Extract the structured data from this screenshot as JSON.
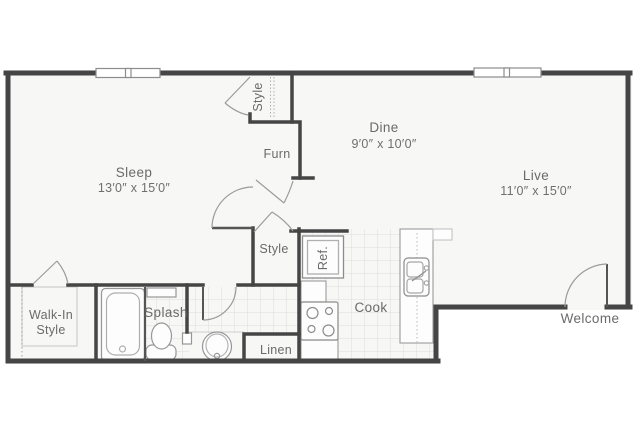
{
  "plan": {
    "type": "apartment-floor-plan",
    "rooms": {
      "sleep": {
        "label": "Sleep",
        "dims": "13′0″ x 15′0″"
      },
      "dine": {
        "label": "Dine",
        "dims": "9′0″ x 10′0″"
      },
      "live": {
        "label": "Live",
        "dims": "11′0″ x 15′0″"
      },
      "furnace": {
        "label": "Furn"
      },
      "closet_top": {
        "label": "Style"
      },
      "closet_hall": {
        "label": "Style"
      },
      "walk_in": {
        "label_line1": "Walk-In",
        "label_line2": "Style"
      },
      "bathroom": {
        "label": "Splash"
      },
      "linen": {
        "label": "Linen"
      },
      "kitchen": {
        "label": "Cook"
      },
      "refrigerator": {
        "label": "Ref."
      },
      "entry": {
        "label": "Welcome"
      }
    },
    "fixtures": [
      "bathtub",
      "toilet",
      "vanity-sink",
      "refrigerator",
      "stove",
      "kitchen-island-double-sink"
    ],
    "windows": 2,
    "colors": {
      "wall": "#454545",
      "floor": "#f7f7f6",
      "tile_line": "#dcdcdc",
      "fixture_line": "#979797",
      "door_line": "#9b9b9b",
      "label_text": "#6a6a6a",
      "background": "#ffffff"
    }
  }
}
